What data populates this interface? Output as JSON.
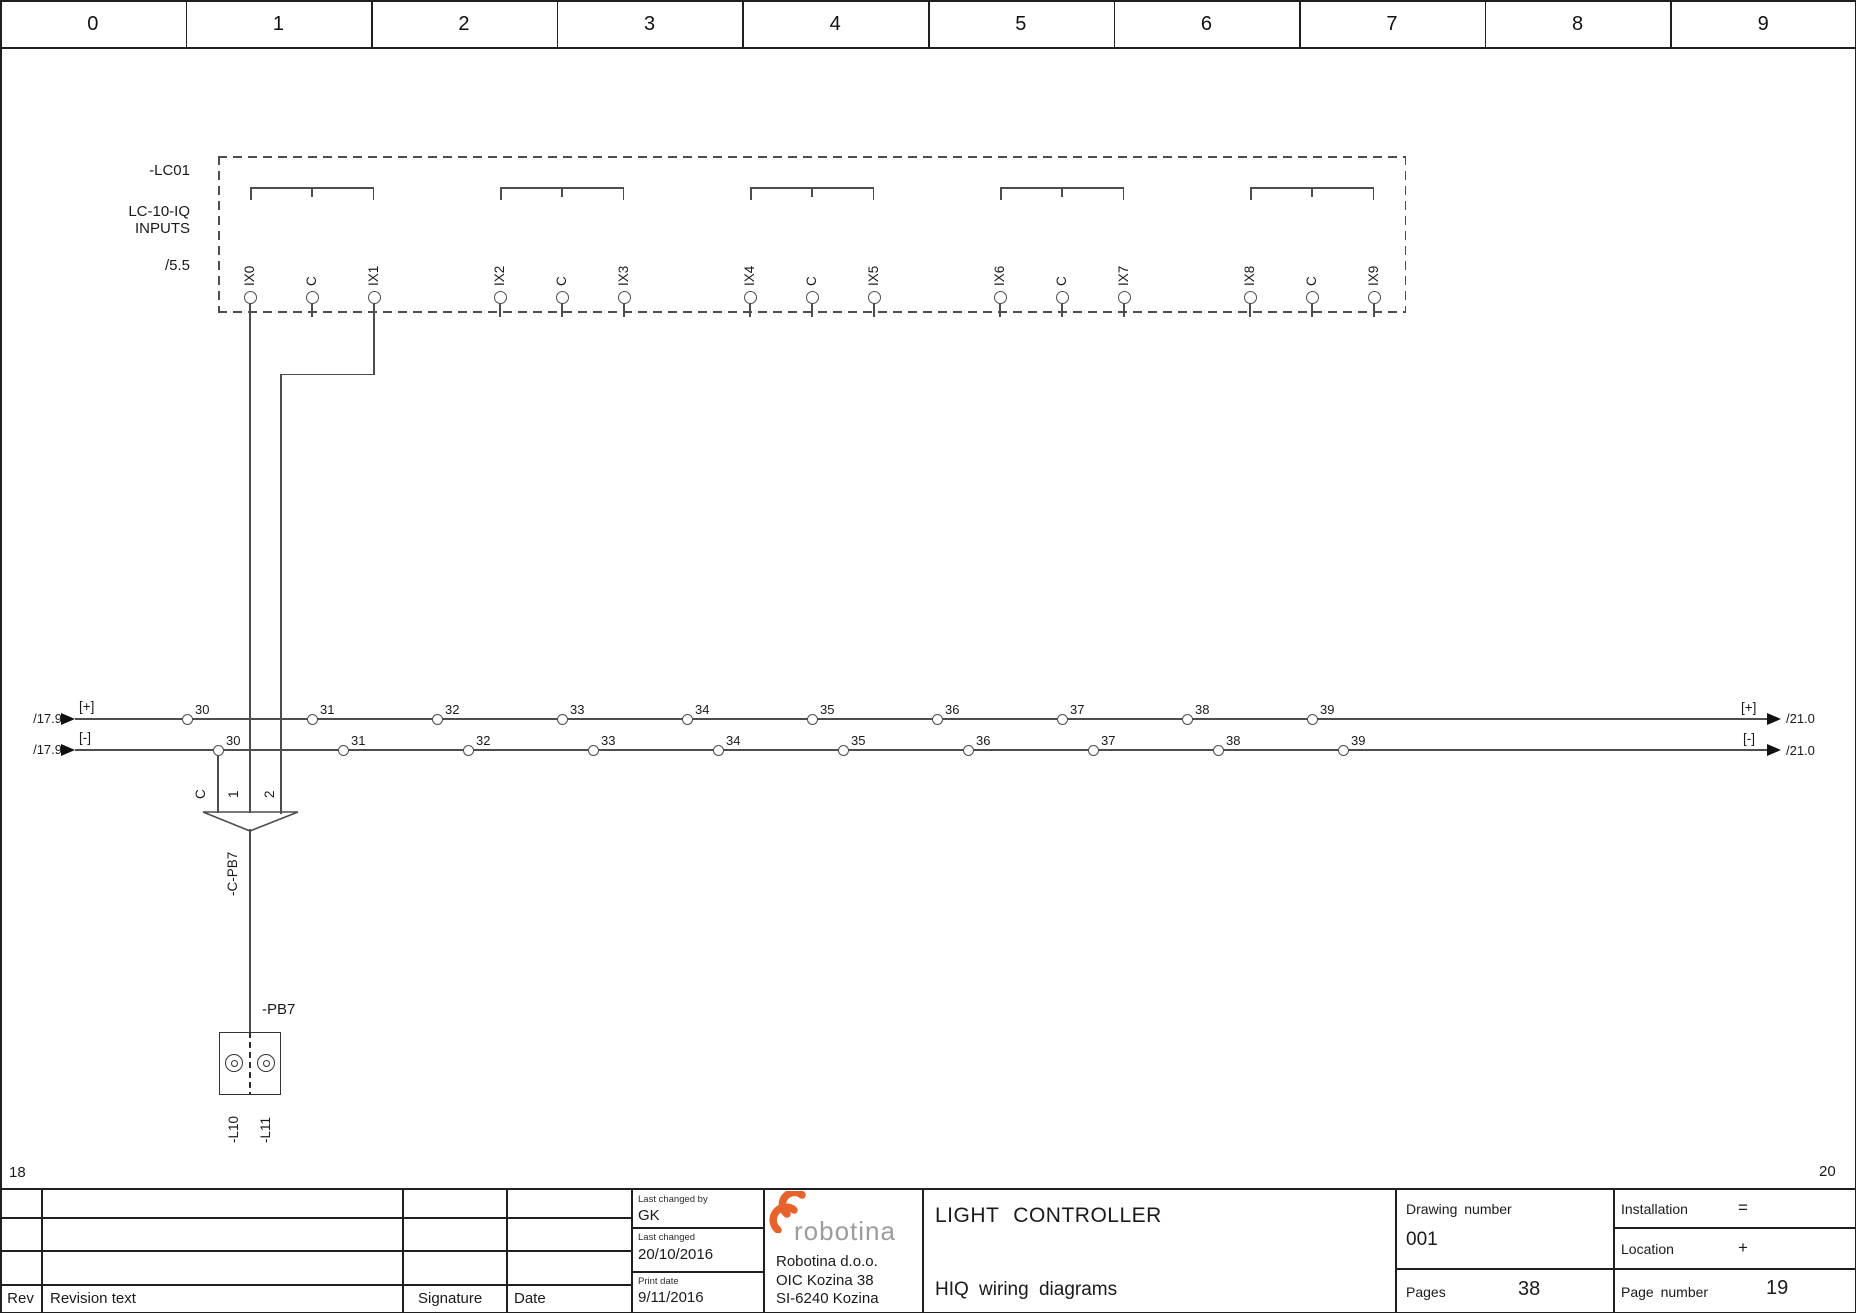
{
  "page": {
    "prev": "18",
    "next": "20"
  },
  "ruler": {
    "columns": [
      "0",
      "1",
      "2",
      "3",
      "4",
      "5",
      "6",
      "7",
      "8",
      "9"
    ]
  },
  "module": {
    "tag": "-LC01",
    "type": "LC-10-IQ",
    "subtype": "INPUTS",
    "ref": "/5.5",
    "terminals": [
      "IX0",
      "C",
      "IX1",
      "IX2",
      "C",
      "IX3",
      "IX4",
      "C",
      "IX5",
      "IX6",
      "C",
      "IX7",
      "IX8",
      "C",
      "IX9"
    ]
  },
  "bus": {
    "plus": {
      "left_ref": "/17.9",
      "polarity": "[+]",
      "right_ref": "/21.0",
      "terminals": [
        "30",
        "31",
        "32",
        "33",
        "34",
        "35",
        "36",
        "37",
        "38",
        "39"
      ]
    },
    "minus": {
      "left_ref": "/17.9",
      "polarity": "[-]",
      "right_ref": "/21.0",
      "terminals": [
        "30",
        "31",
        "32",
        "33",
        "34",
        "35",
        "36",
        "37",
        "38",
        "39"
      ]
    }
  },
  "cable": {
    "tag": "-C-PB7",
    "wires": [
      "C",
      "1",
      "2"
    ]
  },
  "device": {
    "tag": "-PB7",
    "terminals": [
      "-L10",
      "-L11"
    ]
  },
  "titleblock": {
    "revision": {
      "rev": "Rev",
      "revision_text": "Revision text",
      "signature": "Signature",
      "date": "Date"
    },
    "meta": {
      "last_changed_by_label": "Last changed by",
      "last_changed_by": "GK",
      "last_changed_label": "Last changed",
      "last_changed": "20/10/2016",
      "print_date_label": "Print date",
      "print_date": "9/11/2016"
    },
    "company": {
      "logo_text": "robotina",
      "lines": [
        "Robotina d.o.o.",
        "OIC Kozina 38",
        "SI-6240 Kozina"
      ]
    },
    "doc": {
      "title": "LIGHT CONTROLLER",
      "subtitle": "HIQ wiring diagrams"
    },
    "drawing": {
      "number_label": "Drawing number",
      "number": "001",
      "pages_label": "Pages",
      "pages": "38"
    },
    "location": {
      "installation_label": "Installation",
      "installation": "=",
      "location_label": "Location",
      "location": "+",
      "page_number_label": "Page number",
      "page_number": "19"
    }
  },
  "colors": {
    "line": "#4d4d4d",
    "accent": "#e8632c",
    "logo_gray": "#9c9c9c"
  }
}
